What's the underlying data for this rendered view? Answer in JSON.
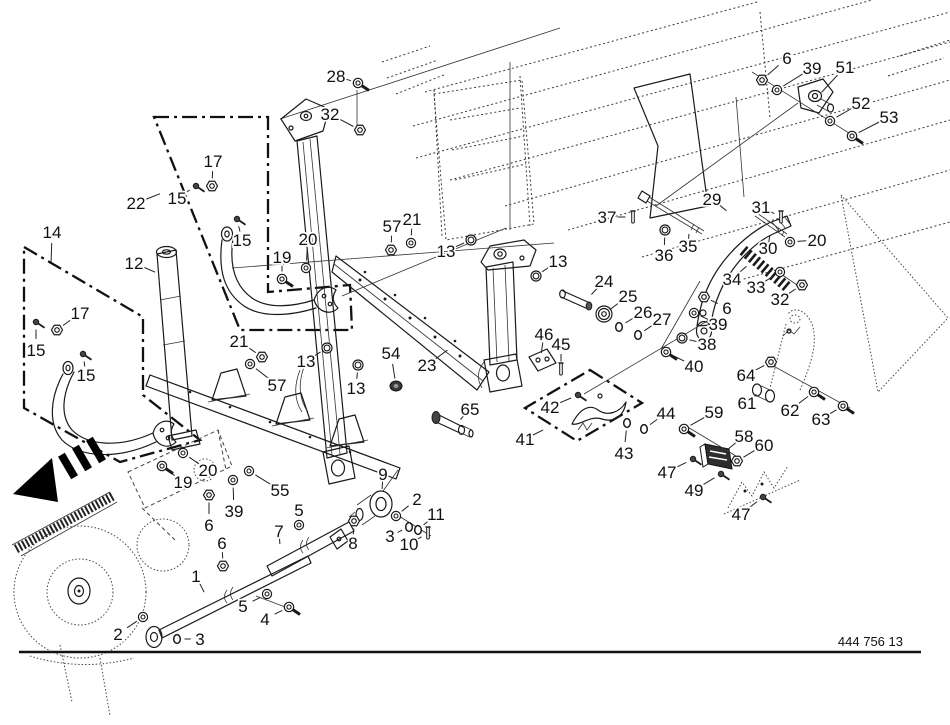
{
  "figure": {
    "drawing_number": "444 756 13"
  },
  "colors": {
    "ink": "#1a1a1a",
    "paper": "#ffffff"
  },
  "labels": [
    {
      "n": "28",
      "x": 336,
      "y": 76,
      "ex": 358,
      "ey": 83,
      "g": "bolt"
    },
    {
      "n": "32",
      "x": 330,
      "y": 114,
      "ex": 360,
      "ey": 130,
      "g": "nut"
    },
    {
      "n": "17",
      "x": 213,
      "y": 161,
      "ex": 212,
      "ey": 186,
      "g": "nut"
    },
    {
      "n": "15",
      "x": 177,
      "y": 198,
      "ex": 196,
      "ey": 186,
      "g": "screw"
    },
    {
      "n": "15",
      "x": 242,
      "y": 240,
      "ex": 237,
      "ey": 219,
      "g": "screw"
    },
    {
      "n": "22",
      "x": 136,
      "y": 203,
      "ex": 162,
      "ey": 193,
      "g": "none"
    },
    {
      "n": "14",
      "x": 52,
      "y": 232,
      "ex": 51,
      "ey": 264,
      "g": "none"
    },
    {
      "n": "12",
      "x": 134,
      "y": 263,
      "ex": 157,
      "ey": 273,
      "g": "none"
    },
    {
      "n": "19",
      "x": 282,
      "y": 257,
      "ex": 282,
      "ey": 279,
      "g": "bolt"
    },
    {
      "n": "20",
      "x": 308,
      "y": 239,
      "ex": 306,
      "ey": 268,
      "g": "washer"
    },
    {
      "n": "57",
      "x": 392,
      "y": 226,
      "ex": 391,
      "ey": 250,
      "g": "nut"
    },
    {
      "n": "21",
      "x": 412,
      "y": 219,
      "ex": 411,
      "ey": 243,
      "g": "washer"
    },
    {
      "n": "13",
      "x": 446,
      "y": 251,
      "ex": 471,
      "ey": 240,
      "g": "sleeve"
    },
    {
      "n": "13",
      "x": 558,
      "y": 261,
      "ex": 536,
      "ey": 276,
      "g": "sleeve"
    },
    {
      "n": "17",
      "x": 80,
      "y": 313,
      "ex": 57,
      "ey": 330,
      "g": "nut"
    },
    {
      "n": "15",
      "x": 36,
      "y": 350,
      "ex": 36,
      "ey": 322,
      "g": "screw"
    },
    {
      "n": "15",
      "x": 86,
      "y": 375,
      "ex": 83,
      "ey": 354,
      "g": "screw"
    },
    {
      "n": "21",
      "x": 239,
      "y": 341,
      "ex": 262,
      "ey": 357,
      "g": "nut"
    },
    {
      "n": "57",
      "x": 277,
      "y": 385,
      "ex": 250,
      "ey": 364,
      "g": "washer"
    },
    {
      "n": "13",
      "x": 306,
      "y": 361,
      "ex": 327,
      "ey": 348,
      "g": "sleeve"
    },
    {
      "n": "13",
      "x": 356,
      "y": 388,
      "ex": 358,
      "ey": 365,
      "g": "sleeve"
    },
    {
      "n": "54",
      "x": 391,
      "y": 353,
      "ex": 396,
      "ey": 386,
      "g": "plug"
    },
    {
      "n": "23",
      "x": 427,
      "y": 365,
      "ex": 449,
      "ey": 349,
      "g": "none"
    },
    {
      "n": "65",
      "x": 470,
      "y": 409,
      "ex": 459,
      "ey": 421,
      "g": "none"
    },
    {
      "n": "46",
      "x": 544,
      "y": 334,
      "ex": 541,
      "ey": 355,
      "g": "none"
    },
    {
      "n": "45",
      "x": 561,
      "y": 344,
      "ex": 561,
      "ey": 369,
      "g": "pin"
    },
    {
      "n": "42",
      "x": 550,
      "y": 407,
      "ex": 578,
      "ey": 395,
      "g": "screw"
    },
    {
      "n": "41",
      "x": 525,
      "y": 439,
      "ex": 545,
      "ey": 429,
      "g": "none"
    },
    {
      "n": "43",
      "x": 624,
      "y": 453,
      "ex": 627,
      "ey": 423,
      "g": "ring"
    },
    {
      "n": "44",
      "x": 666,
      "y": 413,
      "ex": 644,
      "ey": 429,
      "g": "ring"
    },
    {
      "n": "24",
      "x": 604,
      "y": 281,
      "ex": 590,
      "ey": 296,
      "g": "none"
    },
    {
      "n": "25",
      "x": 628,
      "y": 296,
      "ex": 608,
      "ey": 311,
      "g": "none"
    },
    {
      "n": "26",
      "x": 643,
      "y": 312,
      "ex": 619,
      "ey": 327,
      "g": "ring"
    },
    {
      "n": "27",
      "x": 662,
      "y": 319,
      "ex": 638,
      "ey": 335,
      "g": "ring"
    },
    {
      "n": "37",
      "x": 607,
      "y": 217,
      "ex": 633,
      "ey": 217,
      "g": "pin"
    },
    {
      "n": "36",
      "x": 664,
      "y": 255,
      "ex": 665,
      "ey": 230,
      "g": "sleeve"
    },
    {
      "n": "35",
      "x": 688,
      "y": 246,
      "ex": 689,
      "ey": 232,
      "g": "none"
    },
    {
      "n": "29",
      "x": 712,
      "y": 199,
      "ex": 728,
      "ey": 212,
      "g": "none"
    },
    {
      "n": "31",
      "x": 761,
      "y": 207,
      "ex": 781,
      "ey": 217,
      "g": "pin"
    },
    {
      "n": "30",
      "x": 768,
      "y": 248,
      "ex": 770,
      "ey": 234,
      "g": "none"
    },
    {
      "n": "20",
      "x": 817,
      "y": 240,
      "ex": 790,
      "ey": 242,
      "g": "washer"
    },
    {
      "n": "34",
      "x": 732,
      "y": 279,
      "ex": 748,
      "ey": 265,
      "g": "none"
    },
    {
      "n": "33",
      "x": 756,
      "y": 287,
      "ex": 780,
      "ey": 272,
      "g": "washer"
    },
    {
      "n": "32",
      "x": 780,
      "y": 299,
      "ex": 802,
      "ey": 285,
      "g": "nut"
    },
    {
      "n": "6",
      "x": 727,
      "y": 308,
      "ex": 704,
      "ey": 297,
      "g": "nut"
    },
    {
      "n": "39",
      "x": 718,
      "y": 324,
      "ex": 694,
      "ey": 313,
      "g": "washer"
    },
    {
      "n": "38",
      "x": 707,
      "y": 344,
      "ex": 682,
      "ey": 338,
      "g": "sleeve"
    },
    {
      "n": "40",
      "x": 694,
      "y": 366,
      "ex": 666,
      "ey": 352,
      "g": "bolt"
    },
    {
      "n": "6",
      "x": 787,
      "y": 58,
      "ex": 762,
      "ey": 80,
      "g": "nut"
    },
    {
      "n": "39",
      "x": 812,
      "y": 68,
      "ex": 777,
      "ey": 90,
      "g": "washer"
    },
    {
      "n": "51",
      "x": 845,
      "y": 67,
      "ex": 820,
      "ey": 94,
      "g": "none"
    },
    {
      "n": "52",
      "x": 861,
      "y": 103,
      "ex": 830,
      "ey": 121,
      "g": "washer"
    },
    {
      "n": "53",
      "x": 889,
      "y": 117,
      "ex": 852,
      "ey": 136,
      "g": "bolt"
    },
    {
      "n": "64",
      "x": 746,
      "y": 375,
      "ex": 771,
      "ey": 362,
      "g": "nut"
    },
    {
      "n": "61",
      "x": 747,
      "y": 403,
      "ex": 758,
      "ey": 393,
      "g": "none"
    },
    {
      "n": "62",
      "x": 790,
      "y": 410,
      "ex": 814,
      "ey": 392,
      "g": "bolt"
    },
    {
      "n": "63",
      "x": 821,
      "y": 419,
      "ex": 843,
      "ey": 406,
      "g": "bolt"
    },
    {
      "n": "59",
      "x": 714,
      "y": 412,
      "ex": 684,
      "ey": 429,
      "g": "bolt"
    },
    {
      "n": "58",
      "x": 744,
      "y": 436,
      "ex": 727,
      "ey": 450,
      "g": "none"
    },
    {
      "n": "60",
      "x": 764,
      "y": 445,
      "ex": 737,
      "ey": 461,
      "g": "nut"
    },
    {
      "n": "47",
      "x": 667,
      "y": 472,
      "ex": 693,
      "ey": 459,
      "g": "screw"
    },
    {
      "n": "49",
      "x": 694,
      "y": 490,
      "ex": 721,
      "ey": 474,
      "g": "screw"
    },
    {
      "n": "47",
      "x": 741,
      "y": 514,
      "ex": 763,
      "ey": 497,
      "g": "screw"
    },
    {
      "n": "9",
      "x": 383,
      "y": 474,
      "ex": 382,
      "ey": 491,
      "g": "none"
    },
    {
      "n": "2",
      "x": 417,
      "y": 499,
      "ex": 396,
      "ey": 516,
      "g": "washer"
    },
    {
      "n": "11",
      "x": 436,
      "y": 514,
      "ex": 418,
      "ey": 530,
      "g": "ring"
    },
    {
      "n": "3",
      "x": 390,
      "y": 536,
      "ex": 409,
      "ey": 527,
      "g": "ring"
    },
    {
      "n": "10",
      "x": 409,
      "y": 544,
      "ex": 428,
      "ey": 533,
      "g": "pin"
    },
    {
      "n": "5",
      "x": 299,
      "y": 510,
      "ex": 299,
      "ey": 525,
      "g": "washer"
    },
    {
      "n": "7",
      "x": 279,
      "y": 531,
      "ex": 280,
      "ey": 546,
      "g": "none"
    },
    {
      "n": "8",
      "x": 353,
      "y": 543,
      "ex": 354,
      "ey": 521,
      "g": "nut"
    },
    {
      "n": "6",
      "x": 222,
      "y": 543,
      "ex": 223,
      "ey": 566,
      "g": "nut"
    },
    {
      "n": "1",
      "x": 196,
      "y": 576,
      "ex": 205,
      "ey": 594,
      "g": "none"
    },
    {
      "n": "5",
      "x": 243,
      "y": 606,
      "ex": 267,
      "ey": 594,
      "g": "washer"
    },
    {
      "n": "4",
      "x": 265,
      "y": 619,
      "ex": 289,
      "ey": 607,
      "g": "bolt"
    },
    {
      "n": "2",
      "x": 118,
      "y": 634,
      "ex": 143,
      "ey": 617,
      "g": "washer"
    },
    {
      "n": "3",
      "x": 200,
      "y": 639,
      "ex": 177,
      "ey": 639,
      "g": "ring"
    },
    {
      "n": "19",
      "x": 183,
      "y": 482,
      "ex": 162,
      "ey": 466,
      "g": "bolt"
    },
    {
      "n": "20",
      "x": 208,
      "y": 470,
      "ex": 183,
      "ey": 453,
      "g": "washer"
    },
    {
      "n": "55",
      "x": 280,
      "y": 490,
      "ex": 249,
      "ey": 471,
      "g": "washer"
    },
    {
      "n": "39",
      "x": 234,
      "y": 511,
      "ex": 233,
      "ey": 480,
      "g": "washer"
    },
    {
      "n": "6",
      "x": 209,
      "y": 525,
      "ex": 209,
      "ey": 495,
      "g": "nut"
    }
  ]
}
